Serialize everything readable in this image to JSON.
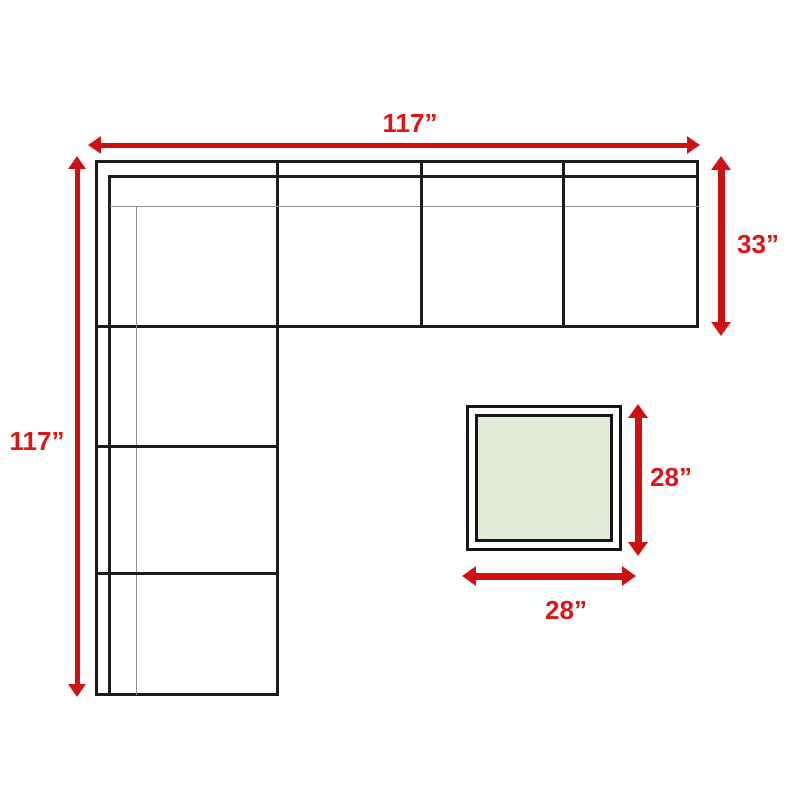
{
  "diagram": {
    "title": "Sectional sofa and ottoman dimension diagram",
    "labels": {
      "sofa_width": "117”",
      "sofa_depth": "117”",
      "section_depth": "33”",
      "ottoman_depth": "28”",
      "ottoman_width": "28”"
    },
    "colors": {
      "arrow": "#cf1111",
      "label_text": "#df1414",
      "outline": "#1c1c1c",
      "seam_gray": "#8f8f8f",
      "ottoman_fill": "#e3ecd9",
      "background": "#ffffff"
    }
  }
}
